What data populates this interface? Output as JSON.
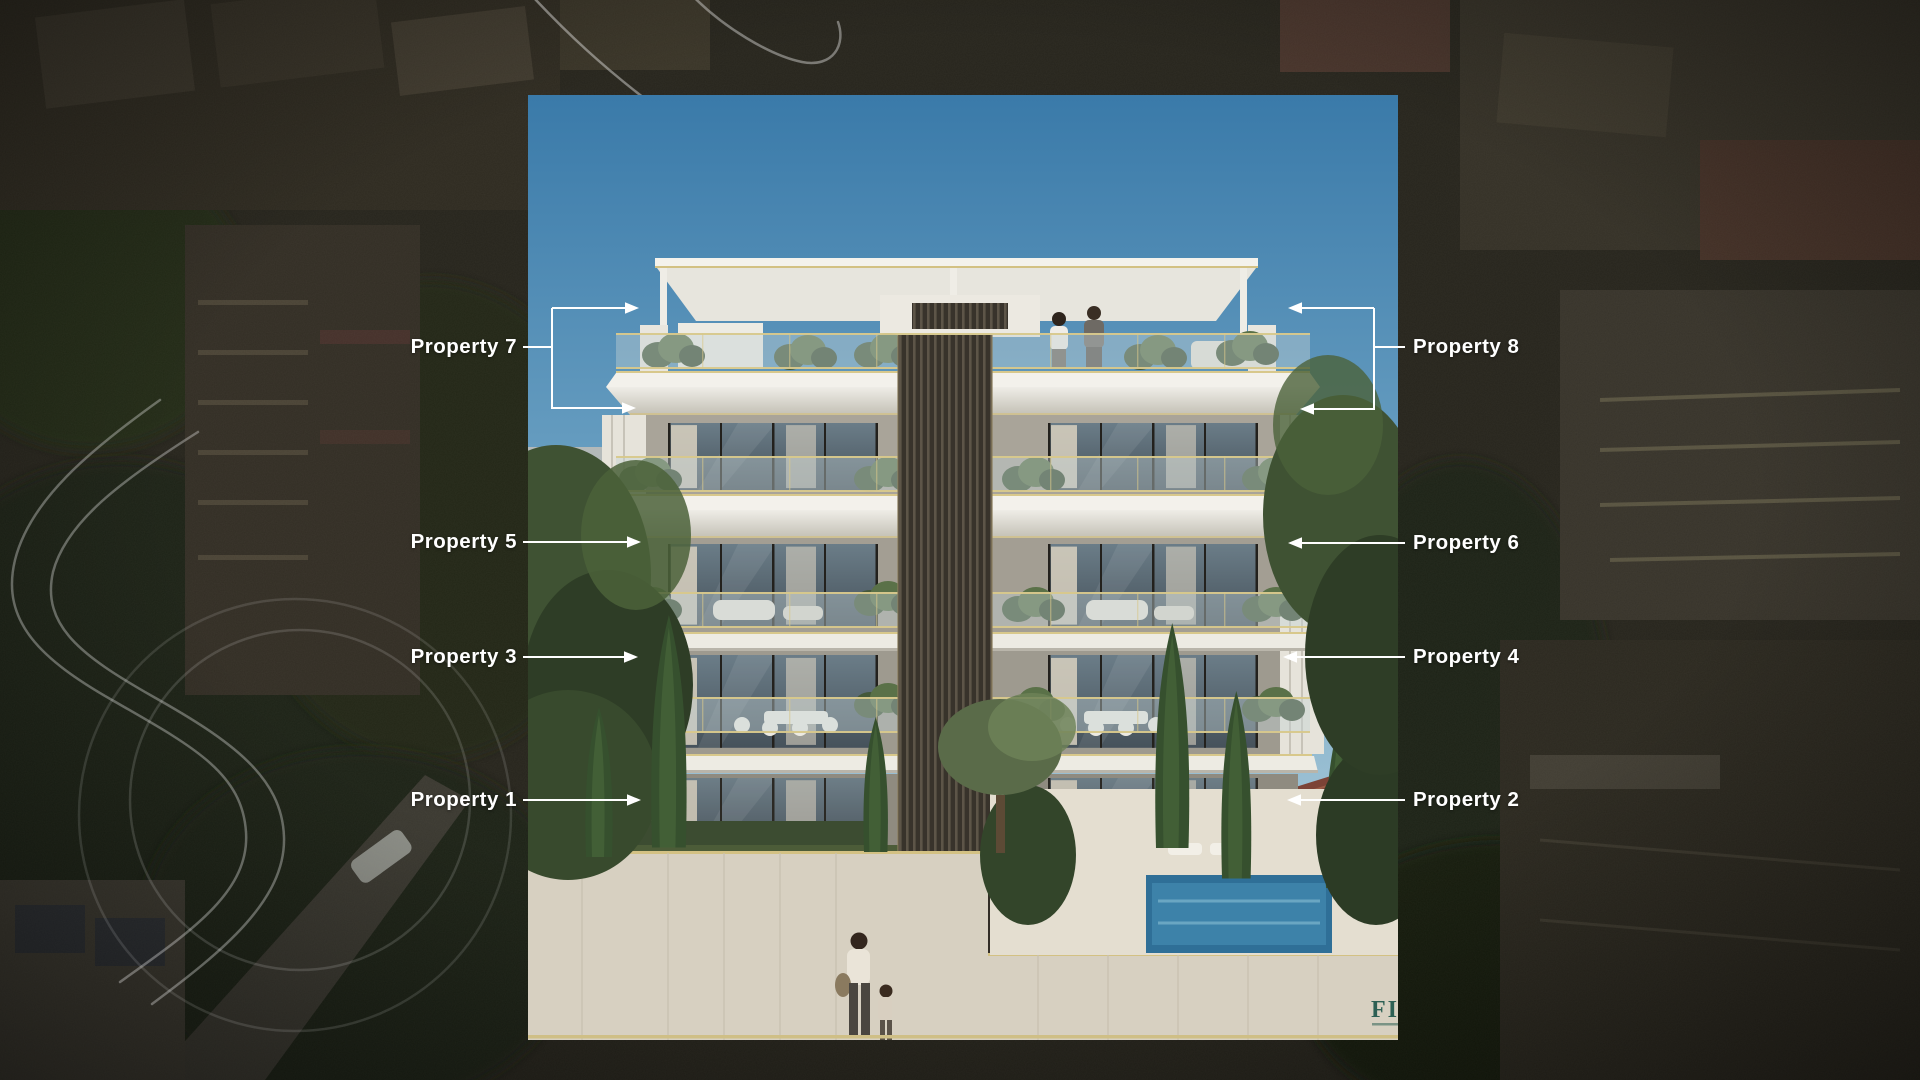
{
  "properties": [
    {
      "label": "Property 1",
      "side": "left"
    },
    {
      "label": "Property 2",
      "side": "right"
    },
    {
      "label": "Property 3",
      "side": "left"
    },
    {
      "label": "Property 4",
      "side": "right"
    },
    {
      "label": "Property 5",
      "side": "left"
    },
    {
      "label": "Property 6",
      "side": "right"
    },
    {
      "label": "Property 7",
      "side": "left"
    },
    {
      "label": "Property 8",
      "side": "right"
    }
  ],
  "watermark": {
    "text": "FIR"
  },
  "colors": {
    "label_text": "#ffffff",
    "connector_line": "#ffffff",
    "gold_trim": "#d3c183",
    "sky_top": "#3a7aa9",
    "logo_teal": "#2d6054",
    "background_dark": "#25231c",
    "pool_blue": "#2f6f97"
  }
}
